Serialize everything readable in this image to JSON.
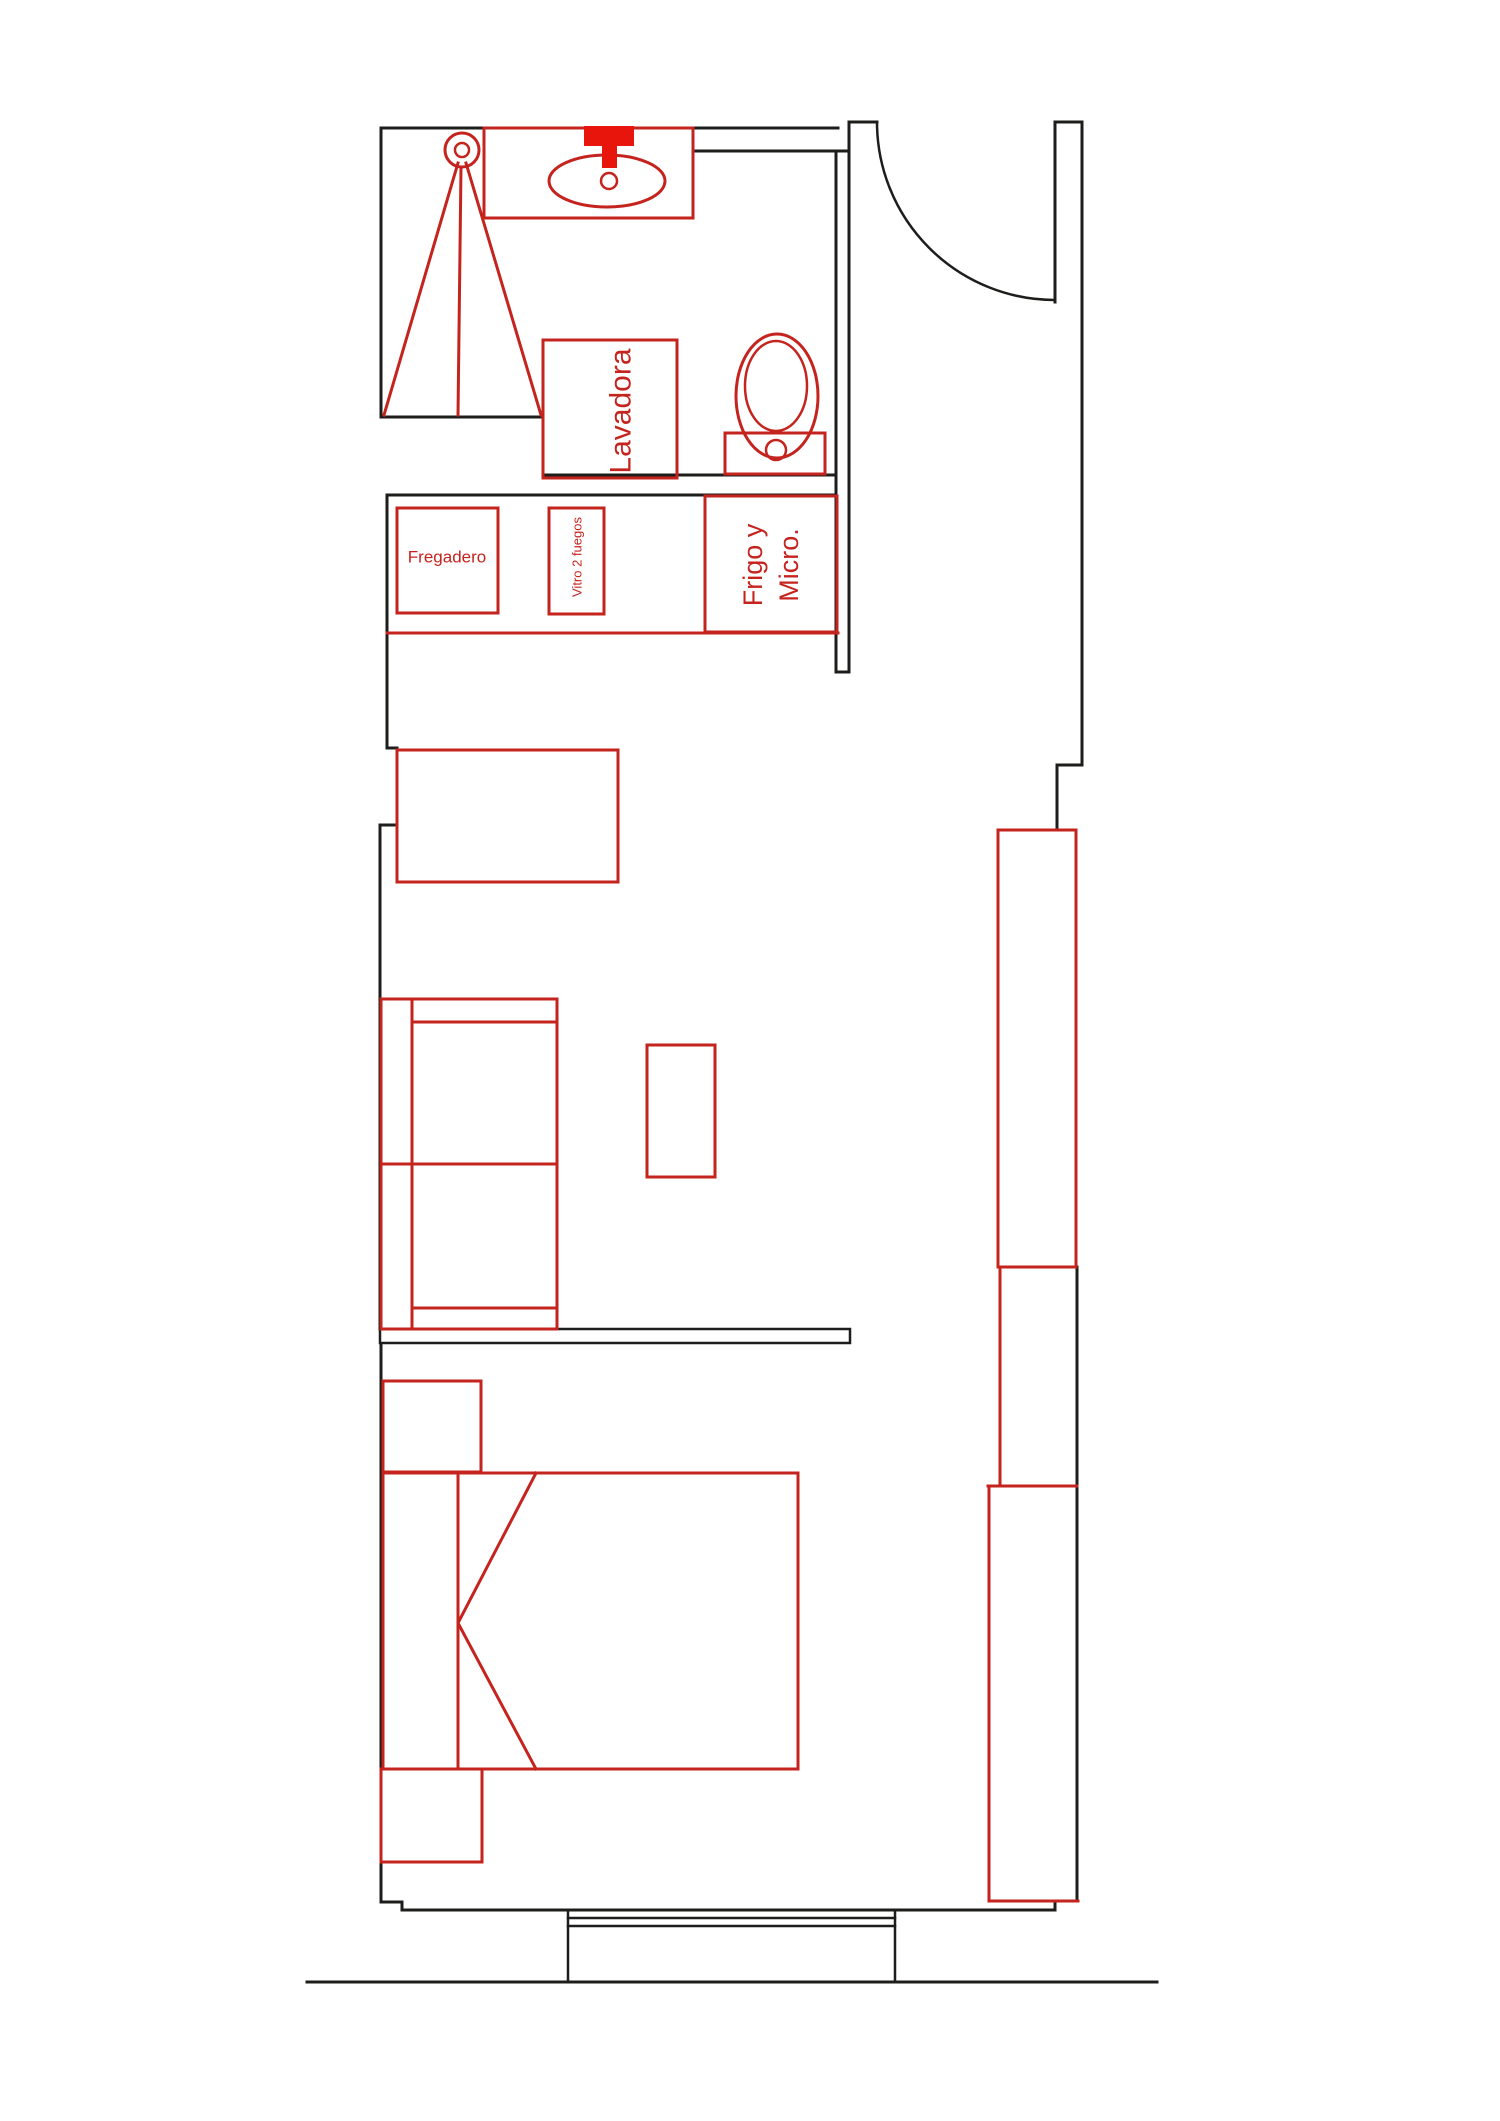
{
  "plan": {
    "labels": {
      "washing_machine": "Lavadora",
      "kitchen_sink": "Fregadero",
      "hob": "Vitro 2 fuegos",
      "fridge_line1": "Frigo y",
      "fridge_line2": "Micro."
    },
    "colors": {
      "wall": "#1d1d1b",
      "furniture": "#c5241e",
      "faucet": "#e8150d",
      "background": "#ffffff"
    }
  }
}
